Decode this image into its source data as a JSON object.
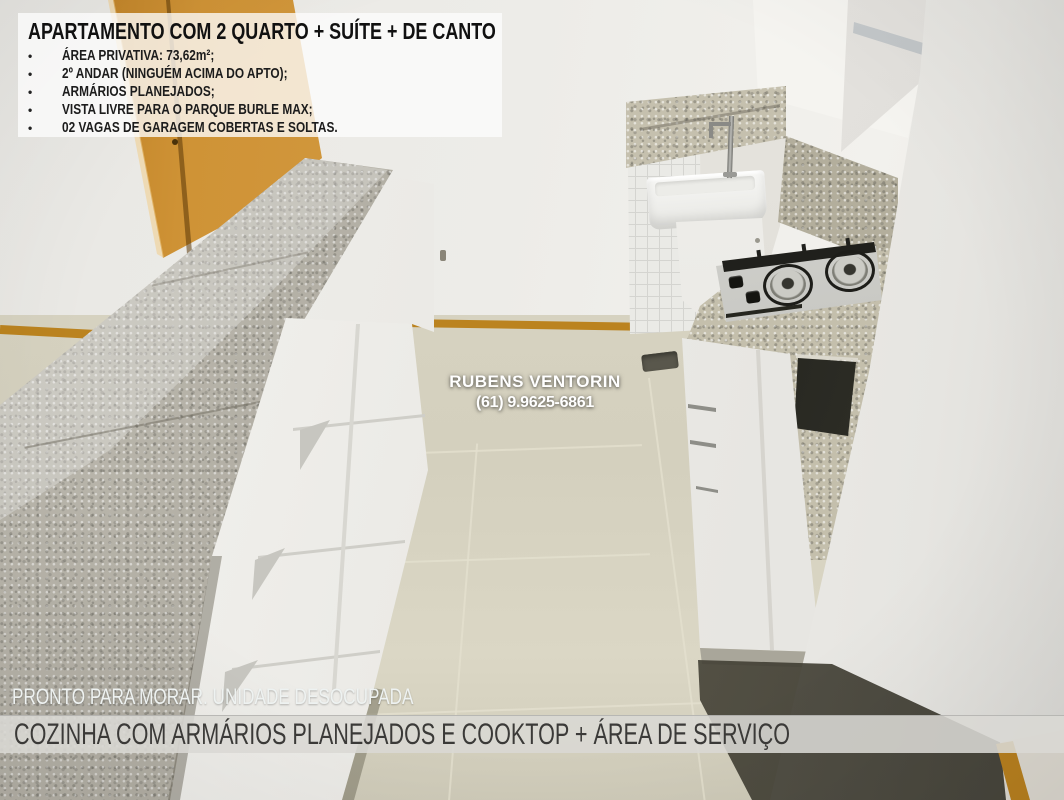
{
  "overlay": {
    "info_box": {
      "title": "APARTAMENTO COM 2 QUARTO + SUÍTE + DE CANTO",
      "bullet_marker": "•",
      "bullets": [
        "ÁREA PRIVATIVA: 73,62m²;",
        "2º ANDAR (NINGUÉM ACIMA DO APTO);",
        "ARMÁRIOS PLANEJADOS;",
        "VISTA LIVRE PARA O PARQUE BURLE MAX;",
        "02 VAGAS DE GARAGEM COBERTAS E SOLTAS."
      ]
    },
    "watermark": {
      "name": "RUBENS VENTORIN",
      "phone": "(61) 9.9625-6861"
    },
    "status_line": "PRONTO PARA MORAR. UNIDADE DESOCUPADA",
    "caption_bar": "COZINHA COM ARMÁRIOS PLANEJADOS E COOKTOP + ÁREA DE SERVIÇO"
  },
  "colors": {
    "door-orange": "#c8862a",
    "baseboard-orange": "#bb831f",
    "granite-base": "#b7b3a7",
    "granite-light": "#c5c0ae",
    "floor-beige": "#d6d2c0",
    "wall-white": "#edece8",
    "caption-bar-bg": "#d9d8d4",
    "caption-text": "#3b3a38",
    "info-box-bg": "#fcfcfc",
    "info-text": "#1c1c1c",
    "watermark-white": "#ffffff"
  }
}
